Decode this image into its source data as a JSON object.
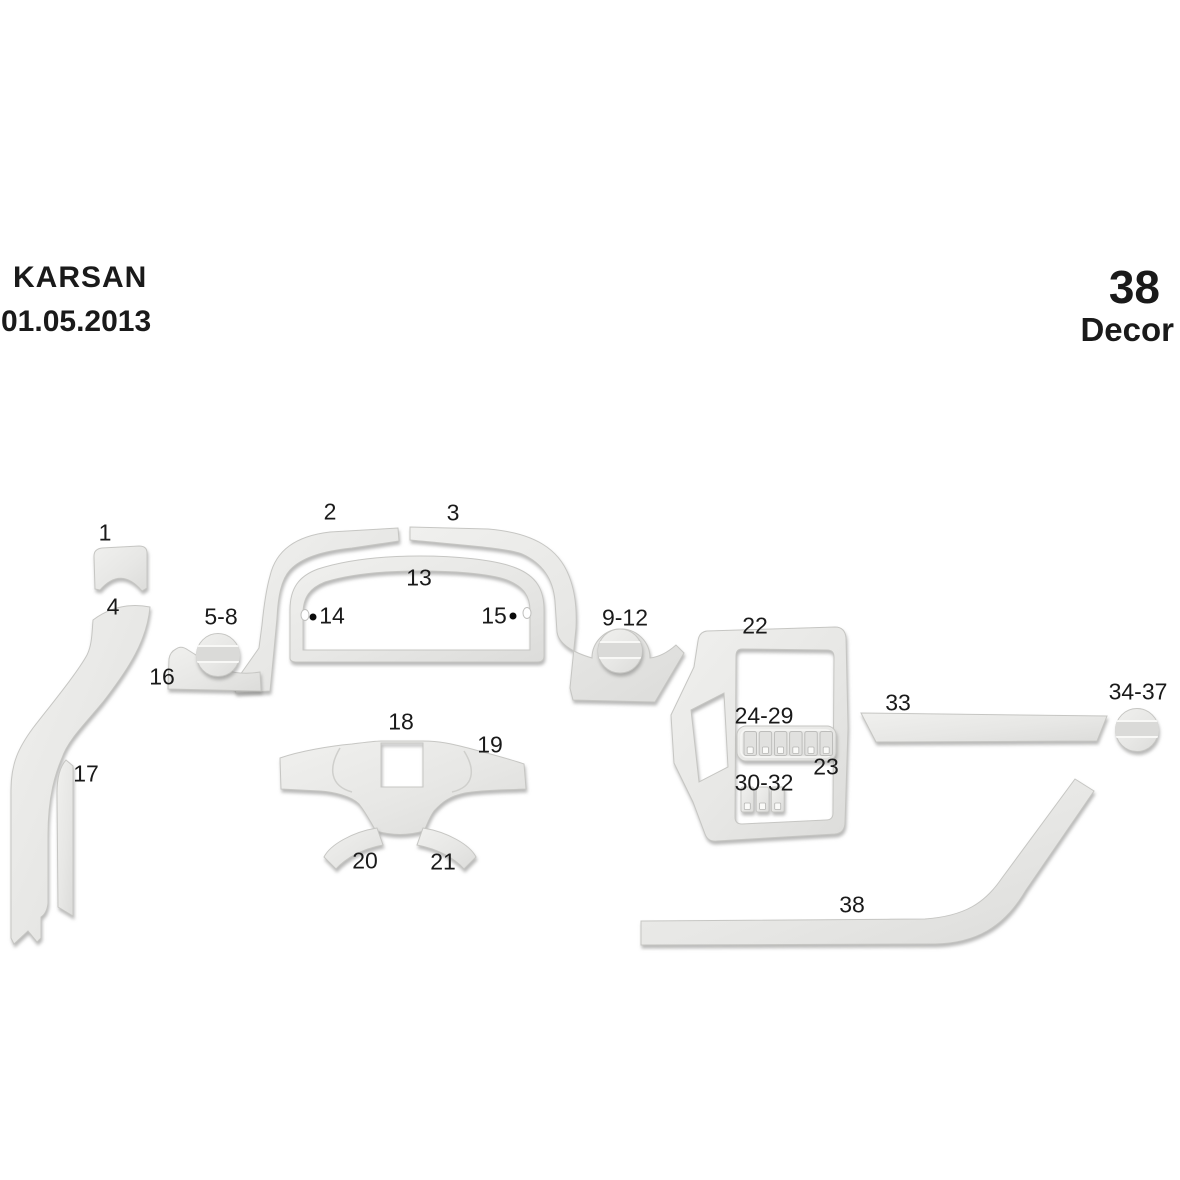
{
  "header": {
    "brand": "KARSAN",
    "date": "01.05.2013"
  },
  "kit": {
    "number": "38",
    "name": "Decor"
  },
  "colors": {
    "background": "#ffffff",
    "piece_fill_light": "#f0f0ee",
    "piece_fill_dark": "#dcdcda",
    "piece_stroke": "#c6c6c3",
    "shadow": "#8a8a88",
    "label_text": "#1a1a1a"
  },
  "diagram": {
    "labels": [
      {
        "part": "1",
        "text": "1",
        "x": 105,
        "y": 533
      },
      {
        "part": "2",
        "text": "2",
        "x": 330,
        "y": 512
      },
      {
        "part": "3",
        "text": "3",
        "x": 453,
        "y": 513
      },
      {
        "part": "4",
        "text": "4",
        "x": 113,
        "y": 607
      },
      {
        "part": "5-8",
        "text": "5-8",
        "x": 221,
        "y": 617
      },
      {
        "part": "13",
        "text": "13",
        "x": 419,
        "y": 578
      },
      {
        "part": "14",
        "text": "14",
        "x": 332,
        "y": 616
      },
      {
        "part": "15",
        "text": "15",
        "x": 494,
        "y": 616
      },
      {
        "part": "9-12",
        "text": "9-12",
        "x": 625,
        "y": 618
      },
      {
        "part": "16",
        "text": "16",
        "x": 162,
        "y": 677
      },
      {
        "part": "22",
        "text": "22",
        "x": 755,
        "y": 626
      },
      {
        "part": "17",
        "text": "17",
        "x": 86,
        "y": 774
      },
      {
        "part": "18",
        "text": "18",
        "x": 401,
        "y": 722
      },
      {
        "part": "19",
        "text": "19",
        "x": 490,
        "y": 745
      },
      {
        "part": "24-29",
        "text": "24-29",
        "x": 764,
        "y": 716
      },
      {
        "part": "33",
        "text": "33",
        "x": 898,
        "y": 703
      },
      {
        "part": "34-37",
        "text": "34-37",
        "x": 1138,
        "y": 692
      },
      {
        "part": "23",
        "text": "23",
        "x": 826,
        "y": 767
      },
      {
        "part": "30-32",
        "text": "30-32",
        "x": 764,
        "y": 783
      },
      {
        "part": "20",
        "text": "20",
        "x": 365,
        "y": 861
      },
      {
        "part": "21",
        "text": "21",
        "x": 443,
        "y": 862
      },
      {
        "part": "38",
        "text": "38",
        "x": 852,
        "y": 905
      }
    ],
    "markers": [
      {
        "name": "screw-dot-14",
        "x": 313,
        "y": 617
      },
      {
        "name": "screw-dot-15",
        "x": 513,
        "y": 616
      }
    ]
  }
}
